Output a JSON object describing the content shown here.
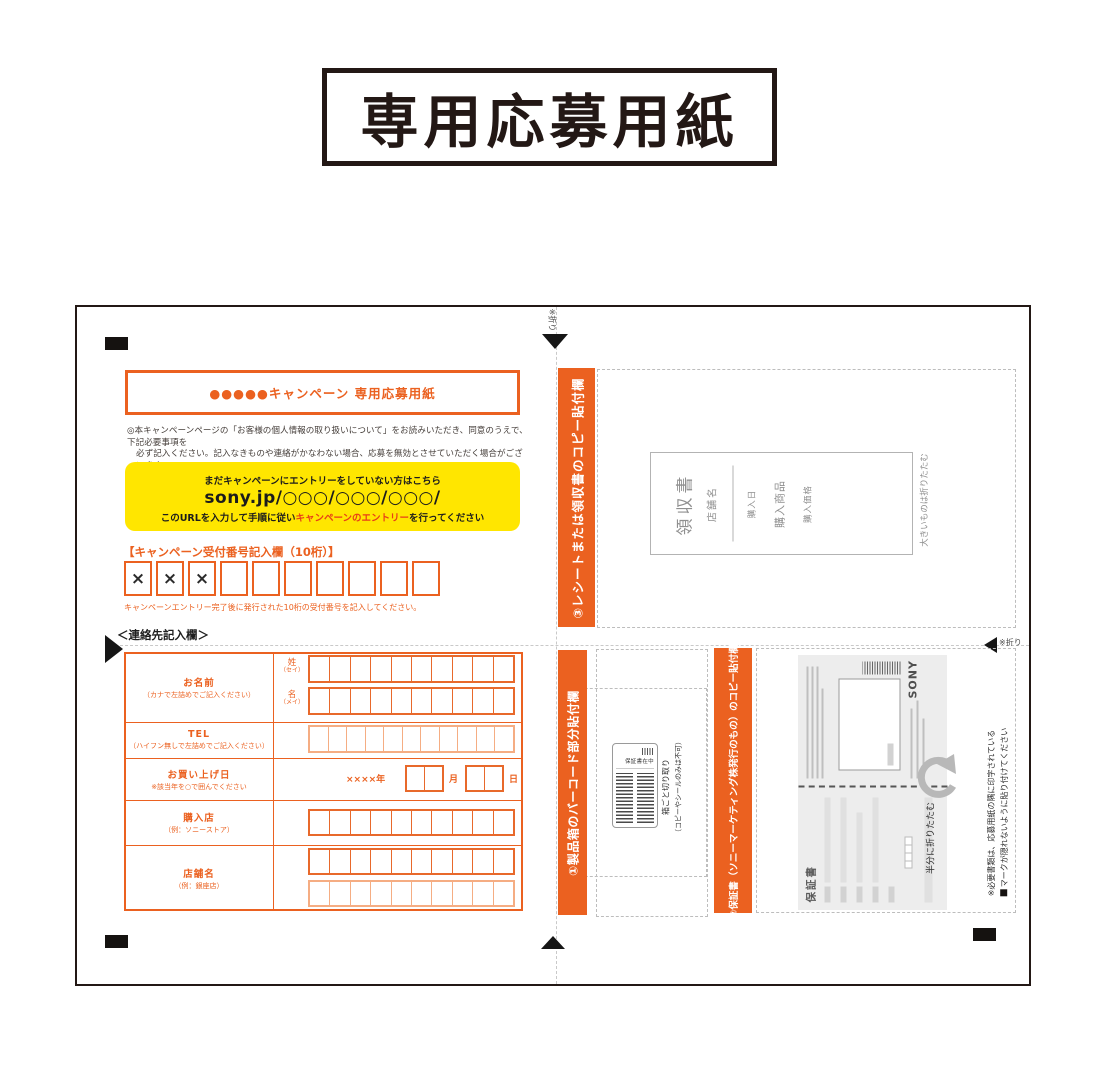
{
  "page_title": "専用応募用紙",
  "form_header": "●●●●●キャンペーン 専用応募用紙",
  "notice": {
    "line1": "◎本キャンペーンページの「お客様の個人情報の取り扱いについて」をお読みいただき、同意のうえで、下記必要事項を",
    "line2": "必ず記入ください。記入なきものや連絡がかなわない場合、応募を無効とさせていただく場合がございます。"
  },
  "entry_box": {
    "lead": "まだキャンペーンにエントリーをしていない方はこちら",
    "url": "sony.jp/○○○/○○○/○○○/",
    "instruction_pre": "このURLを入力して手順に従い",
    "instruction_em": "キャンペーンのエントリー",
    "instruction_post": "を行ってください"
  },
  "reception": {
    "label": "【キャンペーン受付番号記入欄（10桁）】",
    "prefill": [
      "×",
      "×",
      "×"
    ],
    "note": "キャンペーンエントリー完了後に発行された10桁の受付番号を記入してください。"
  },
  "contact": {
    "heading": "＜連絡先記入欄＞",
    "name": {
      "label": "お名前",
      "sub": "（カナで左詰めでご記入ください）",
      "sei": "姓",
      "sei_kana": "（セイ）",
      "mei": "名",
      "mei_kana": "（メイ）"
    },
    "tel": {
      "label": "TEL",
      "sub": "（ハイフン無しで左詰めでご記入ください）"
    },
    "date": {
      "label": "お買い上げ日",
      "sub": "※該当年を○で囲んでください",
      "year": "××××年",
      "month": "月",
      "day": "日"
    },
    "shop": {
      "label": "購入店",
      "sub": "（例：ソニーストア）"
    },
    "store": {
      "label": "店舗名",
      "sub": "（例：銀座店）"
    }
  },
  "fold_marks": {
    "top": "※折り",
    "right": "※折り"
  },
  "section_receipt": {
    "band": "③レシートまたは領収書のコピー貼付欄",
    "sample": {
      "title": "領収書",
      "store": "店舗名",
      "date": "購入日",
      "product": "購入商品",
      "price": "購入価格"
    },
    "note": "大きいものは折りたたむ"
  },
  "section_barcode": {
    "band": "①製品箱のバーコード部分貼付欄",
    "sticker": "保証書在中",
    "caption_line1": "箱ごと切り取り",
    "caption_line2": "（コピーやシールのみは不可）"
  },
  "section_warranty": {
    "band": "②保証書（ソニーマーケティング株発行のもの）のコピー貼付欄",
    "brand": "SONY",
    "doc_title": "保証書",
    "fold_note": "半分に折りたたむ"
  },
  "paste_note": {
    "line1": "※必要書類は、応募用紙の隅に印字されている",
    "line2": "マークが隠れないように貼り付けてください"
  },
  "colors": {
    "orange": "#eb6120",
    "orange_light": "#f5ad83",
    "yellow": "#ffe600",
    "red_accent": "#e83e17",
    "ink": "#231815"
  }
}
